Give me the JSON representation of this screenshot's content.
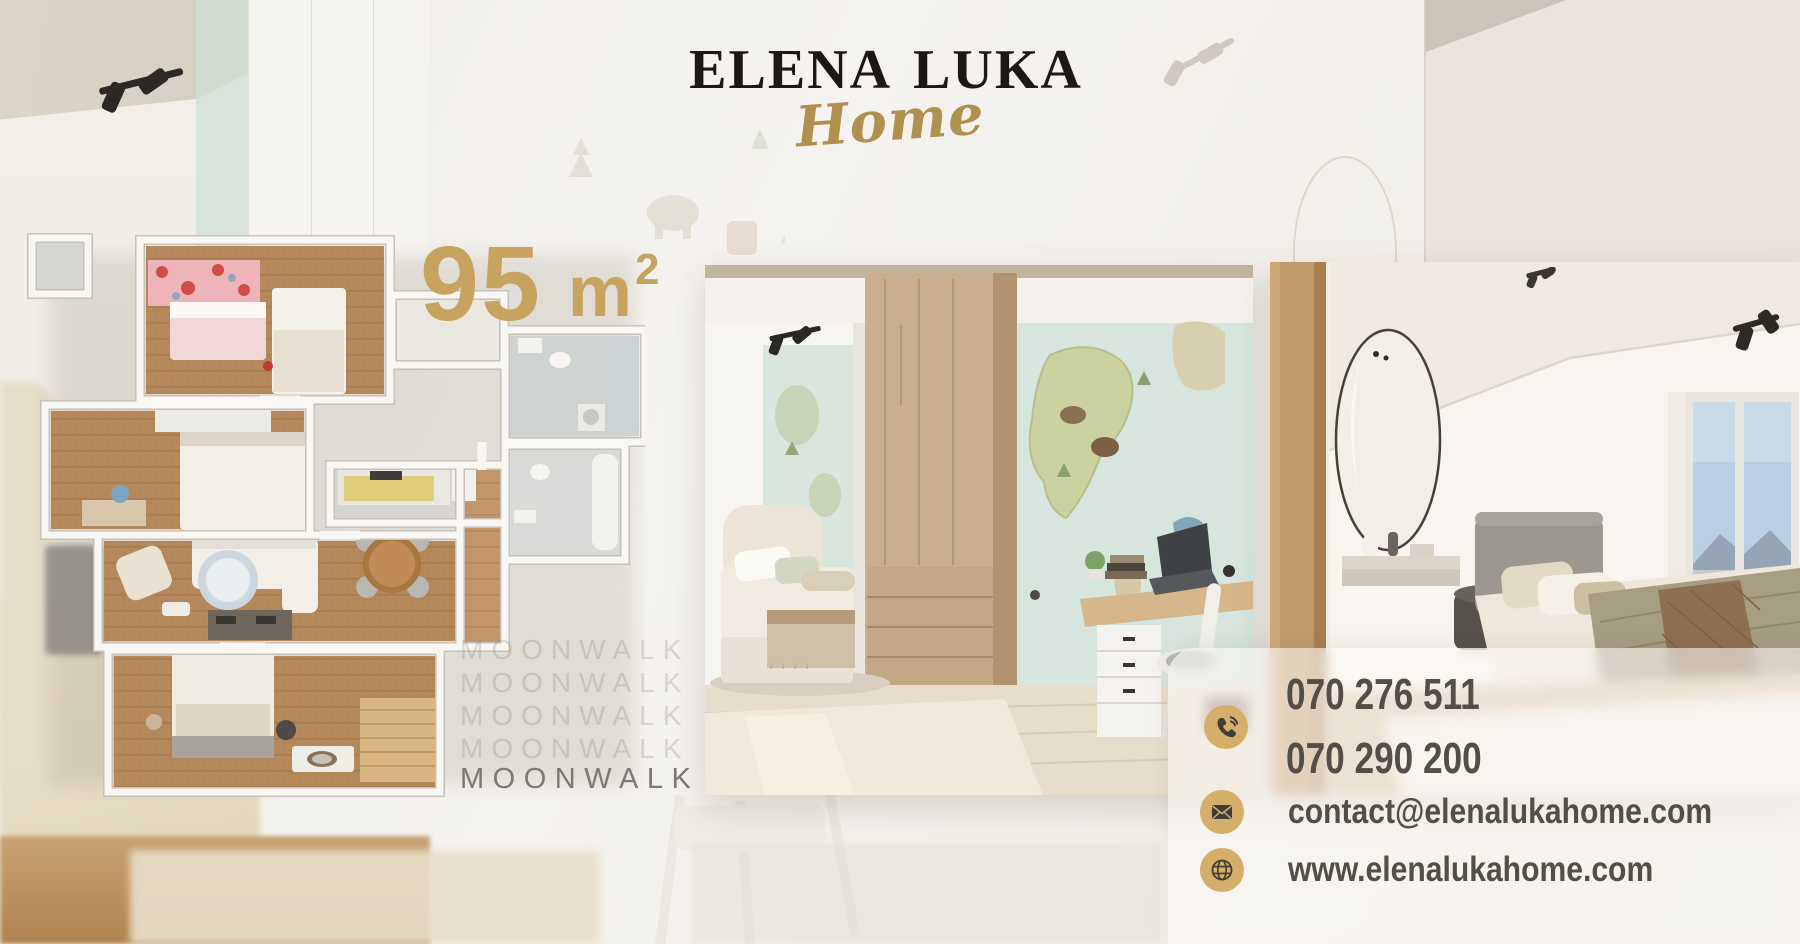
{
  "brand": {
    "name": "ELENA LUKA",
    "subtitle": "Home"
  },
  "listing": {
    "area_number": "95",
    "area_unit": "m",
    "area_exponent": "2"
  },
  "watermark": {
    "text": "MOONWALK"
  },
  "contact": {
    "phone_primary": "070 276 511",
    "phone_secondary": "070 290 200",
    "email": "contact@elenalukahome.com",
    "website": "www.elenalukahome.com"
  },
  "icons": {
    "phone": "phone-icon",
    "email": "envelope-icon",
    "website": "globe-icon"
  },
  "colors": {
    "logo_text": "#1c1814",
    "gold_script": "#b0904e",
    "area_gold": "#c8a360",
    "icon_circle_gold": "#d5ae69",
    "contact_text": "#534e46",
    "watermark_faint": "#d8d3cd",
    "watermark_strong": "#7c7873"
  },
  "photos": {
    "left": "3d-floor-plan-95sqm",
    "center": "kids-room-interior",
    "right": "bedroom-interior"
  }
}
